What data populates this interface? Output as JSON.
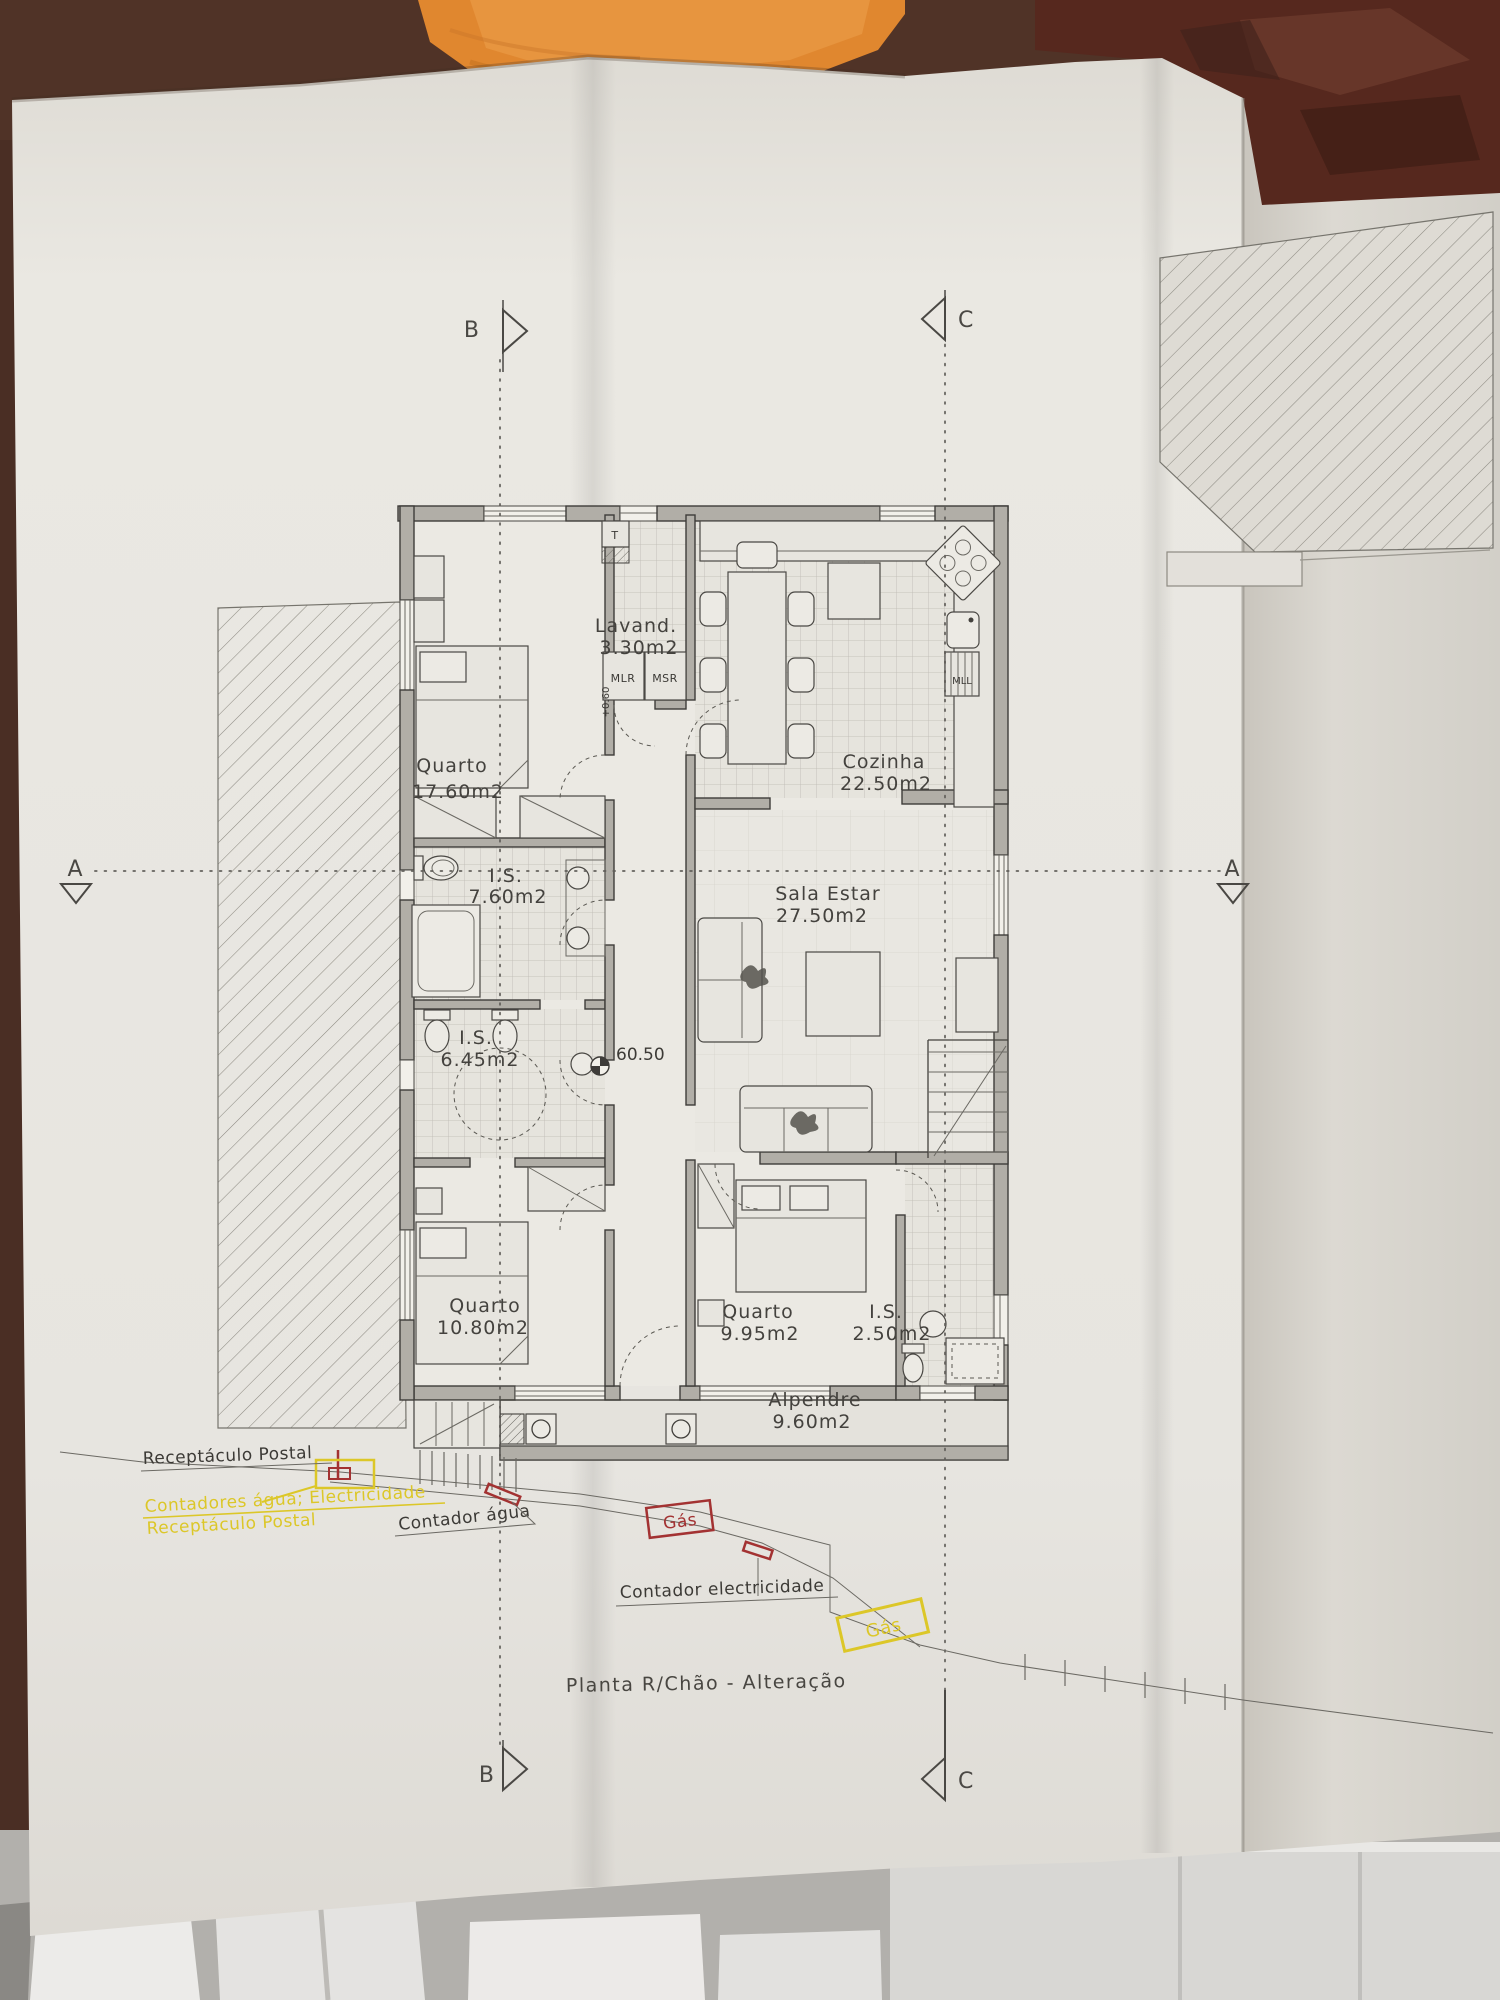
{
  "photo": {
    "scene": "architectural floor plan drawing on a folded paper sheet, photographed on a table",
    "background_objects": [
      "orange towel",
      "dark brown surface",
      "white chair slats"
    ]
  },
  "title_block": {
    "title": "Planta R/Chão - Alteração"
  },
  "section_markers": {
    "a_left": "A",
    "a_right": "A",
    "b_top": "B",
    "b_bottom": "B",
    "c_top": "C",
    "c_bottom": "C"
  },
  "levels": {
    "floor_level": "60.50",
    "step_level": "+0.60"
  },
  "rooms": [
    {
      "name": "Quarto",
      "area": "17.60m2"
    },
    {
      "name": "Lavand.",
      "area": "3.30m2"
    },
    {
      "name": "Cozinha",
      "area": "22.50m2"
    },
    {
      "name": "I.S.",
      "area": "7.60m2"
    },
    {
      "name": "Sala  Estar",
      "area": "27.50m2"
    },
    {
      "name": "I.S.",
      "area": "6.45m2"
    },
    {
      "name": "Quarto",
      "area": "10.80m2"
    },
    {
      "name": "Quarto",
      "area": "9.95m2"
    },
    {
      "name": "I.S.",
      "area": "2.50m2"
    },
    {
      "name": "Alpendre",
      "area": "9.60m2"
    }
  ],
  "appliances": {
    "water_heater": "T",
    "washer": "MLR",
    "dryer": "MSR",
    "dishwasher": "MLL"
  },
  "annotations": {
    "postal_label": "Receptáculo Postal",
    "meters_label": "Contadores água; Electricidade",
    "postal_label_2": "Receptáculo Postal",
    "water_meter_label": "Contador água",
    "gas_label_red": "Gás",
    "electricity_meter_label": "Contador electricidade",
    "gas_label_yellow": "Gás"
  },
  "colors": {
    "annotation_yellow": "#dcc728",
    "annotation_red": "#a33232",
    "line_dark": "#3e3c39",
    "wall_fill": "#b1aea7",
    "paper": "#e7e5e0",
    "towel_orange": "#e0872f",
    "background_brown": "#4a2e24",
    "background_maroon": "#56281e"
  }
}
